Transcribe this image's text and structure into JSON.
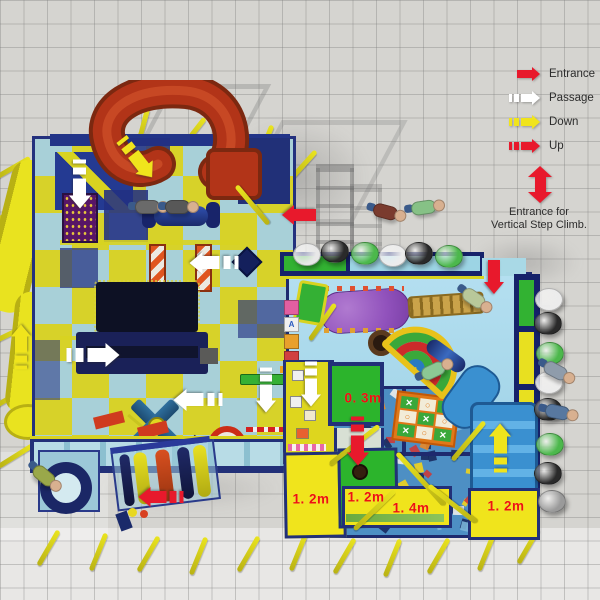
{
  "legend": {
    "items": [
      {
        "type": "entrance",
        "label": "Entrance"
      },
      {
        "type": "passage",
        "label": "Passage"
      },
      {
        "type": "down",
        "label": "Down"
      },
      {
        "type": "up",
        "label": "Up"
      }
    ],
    "vertical_entrance": {
      "lines": [
        "Entrance for",
        "Vertical Step Climb."
      ]
    }
  },
  "arrow_types": {
    "entrance": {
      "color": "#e8192c",
      "dashed": false
    },
    "passage": {
      "color": "#ffffff",
      "dashed": true
    },
    "down": {
      "color": "#f0e41c",
      "dashed": true
    },
    "up": {
      "color": "#e8192c",
      "dashed": true
    }
  },
  "measurements": [
    {
      "value": "0. 3m",
      "x": 363,
      "y": 398
    },
    {
      "value": "1. 2m",
      "x": 311,
      "y": 499
    },
    {
      "value": "1. 2m",
      "x": 366,
      "y": 497
    },
    {
      "value": "1. 4m",
      "x": 411,
      "y": 508
    },
    {
      "value": "1. 2m",
      "x": 506,
      "y": 506
    }
  ],
  "arrows": [
    {
      "type": "passage",
      "x": 80,
      "y": 184,
      "rot": 90,
      "scale": 1.4
    },
    {
      "type": "down",
      "x": 137,
      "y": 158,
      "rot": 52,
      "scale": 1.4
    },
    {
      "type": "passage",
      "x": 214,
      "y": 263,
      "rot": 180,
      "scale": 1.4
    },
    {
      "type": "entrance",
      "x": 299,
      "y": 215,
      "rot": 180,
      "scale": 1.3
    },
    {
      "type": "passage",
      "x": 93,
      "y": 355,
      "rot": 0,
      "scale": 1.5
    },
    {
      "type": "passage",
      "x": 198,
      "y": 400,
      "rot": 180,
      "scale": 1.4
    },
    {
      "type": "down",
      "x": 21,
      "y": 347,
      "rot": -90,
      "scale": 1.3
    },
    {
      "type": "passage",
      "x": 266,
      "y": 390,
      "rot": 90,
      "scale": 1.3
    },
    {
      "type": "passage",
      "x": 311,
      "y": 384,
      "rot": 90,
      "scale": 1.3
    },
    {
      "type": "entrance",
      "x": 494,
      "y": 277,
      "rot": 90,
      "scale": 1.3
    },
    {
      "type": "up",
      "x": 358,
      "y": 441,
      "rot": 90,
      "scale": 1.4
    },
    {
      "type": "up",
      "x": 161,
      "y": 497,
      "rot": 180,
      "scale": 1.3
    },
    {
      "type": "down",
      "x": 500,
      "y": 448,
      "rot": -90,
      "scale": 1.4
    }
  ],
  "beanbags": [
    {
      "x": 306,
      "y": 253,
      "c": "#e8e8e8"
    },
    {
      "x": 334,
      "y": 250,
      "c": "#2a2a2a"
    },
    {
      "x": 364,
      "y": 252,
      "c": "#4cb84c"
    },
    {
      "x": 392,
      "y": 254,
      "c": "#ececec"
    },
    {
      "x": 418,
      "y": 252,
      "c": "#2a2a2a"
    },
    {
      "x": 448,
      "y": 255,
      "c": "#4cb84c"
    },
    {
      "x": 548,
      "y": 298,
      "c": "#ececec"
    },
    {
      "x": 547,
      "y": 322,
      "c": "#2a2a2a"
    },
    {
      "x": 549,
      "y": 352,
      "c": "#4cb84c"
    },
    {
      "x": 548,
      "y": 381,
      "c": "#ececec"
    },
    {
      "x": 547,
      "y": 408,
      "c": "#2a2a2a"
    },
    {
      "x": 549,
      "y": 443,
      "c": "#4cb84c"
    },
    {
      "x": 547,
      "y": 472,
      "c": "#2a2a2a"
    },
    {
      "x": 551,
      "y": 500,
      "c": "#9a9a9a"
    }
  ],
  "people": [
    {
      "x": 390,
      "y": 212,
      "rot": 15,
      "shirt": "#7a3b2e"
    },
    {
      "x": 428,
      "y": 206,
      "rot": -8,
      "shirt": "#86c186"
    },
    {
      "x": 478,
      "y": 300,
      "rot": 35,
      "shirt": "#b8c89a"
    },
    {
      "x": 437,
      "y": 368,
      "rot": -25,
      "shirt": "#8cc894"
    },
    {
      "x": 560,
      "y": 372,
      "rot": 28,
      "shirt": "#8f9cab"
    },
    {
      "x": 562,
      "y": 412,
      "rot": 12,
      "shirt": "#5878a0"
    },
    {
      "x": 48,
      "y": 478,
      "rot": 40,
      "shirt": "#9aa84a"
    },
    {
      "x": 152,
      "y": 206,
      "rot": 0,
      "shirt": "#6a6a6a"
    },
    {
      "x": 182,
      "y": 206,
      "rot": 0,
      "shirt": "#585858"
    }
  ],
  "poles": [
    {
      "x": 90,
      "y": 118,
      "rot": 32
    },
    {
      "x": 140,
      "y": 108,
      "rot": 15
    },
    {
      "x": 190,
      "y": 114,
      "rot": 38
    },
    {
      "x": 262,
      "y": 124,
      "rot": 22
    },
    {
      "x": 300,
      "y": 146,
      "rot": 42
    },
    {
      "x": 10,
      "y": 148,
      "rot": 60
    },
    {
      "x": 3,
      "y": 196,
      "rot": 68
    },
    {
      "x": 1,
      "y": 252,
      "rot": 62
    },
    {
      "x": 3,
      "y": 316,
      "rot": 64
    },
    {
      "x": 7,
      "y": 378,
      "rot": 60
    },
    {
      "x": 13,
      "y": 436,
      "rot": 58
    },
    {
      "x": 46,
      "y": 528,
      "rot": 30
    },
    {
      "x": 96,
      "y": 532,
      "rot": 22
    },
    {
      "x": 146,
      "y": 534,
      "rot": 30
    },
    {
      "x": 196,
      "y": 536,
      "rot": 22
    },
    {
      "x": 246,
      "y": 534,
      "rot": 30
    },
    {
      "x": 296,
      "y": 532,
      "rot": 22
    },
    {
      "x": 342,
      "y": 536,
      "rot": 30
    },
    {
      "x": 390,
      "y": 538,
      "rot": 22
    },
    {
      "x": 436,
      "y": 536,
      "rot": 30
    },
    {
      "x": 484,
      "y": 532,
      "rot": 22
    },
    {
      "x": 526,
      "y": 526,
      "rot": 30
    }
  ],
  "poles_front": [
    {
      "x": 352,
      "y": 414,
      "rot": 52,
      "len": 62
    },
    {
      "x": 418,
      "y": 444,
      "rot": -42,
      "len": 70
    },
    {
      "x": 372,
      "y": 482,
      "rot": 46,
      "len": 56
    },
    {
      "x": 450,
      "y": 474,
      "rot": -52,
      "len": 60
    },
    {
      "x": 466,
      "y": 416,
      "rot": 40,
      "len": 50
    },
    {
      "x": 320,
      "y": 300,
      "rot": 35,
      "len": 44
    },
    {
      "x": 250,
      "y": 180,
      "rot": -40,
      "len": 50
    }
  ],
  "foam_palette": [
    "#f2d41c",
    "#2a5cb0",
    "#cc3a3a",
    "#ececec",
    "#7ab4d8",
    "#1a2a60",
    "#e8882a"
  ],
  "tic_tac_toe": {
    "cells": [
      "x",
      "o",
      "x",
      "o",
      "x",
      "o",
      "x",
      "o",
      "x"
    ],
    "x_glyph": "✕",
    "o_glyph": "○"
  },
  "letter_blocks": [
    {
      "letter": "",
      "bg": "#e35fa1",
      "fg": "#ffffff"
    },
    {
      "letter": "A",
      "bg": "#f0f0f0",
      "fg": "#2a5ac0"
    },
    {
      "letter": "",
      "bg": "#e8a02c",
      "fg": "#ffffff"
    },
    {
      "letter": "",
      "bg": "#d04040",
      "fg": "#ffffff"
    }
  ]
}
